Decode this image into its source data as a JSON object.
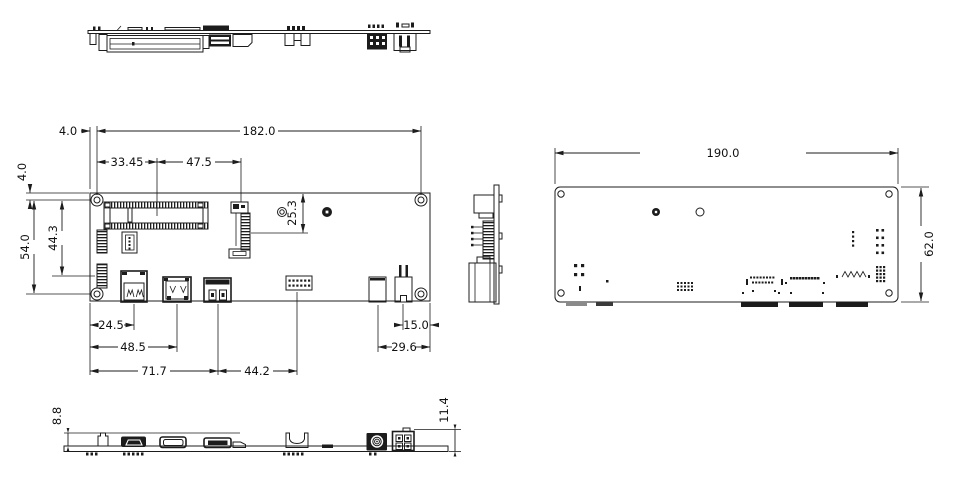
{
  "colors": {
    "line": "#1c1c1c",
    "background": "#ffffff"
  },
  "front_view": {
    "dims": {
      "edge_to_hole_h": "4.0",
      "hole_span_h": "182.0",
      "slot_offset": "33.45",
      "card_offset": "47.5",
      "edge_to_hole_v": "4.0",
      "hole_span_v": "54.0",
      "header_offset_v": "44.3",
      "card_screw_offset": "25.3",
      "usb_center": "24.5",
      "conn2_center": "48.5",
      "conn3_center": "71.7",
      "header_gap": "44.2",
      "power_center": "15.0",
      "dc_center": "29.6"
    }
  },
  "bottom_view": {
    "dims": {
      "board_width": "190.0",
      "board_height": "62.0"
    }
  },
  "bottom_edge_view": {
    "dims": {
      "connector_height_left": "8.8",
      "connector_height_right": "11.4"
    }
  }
}
